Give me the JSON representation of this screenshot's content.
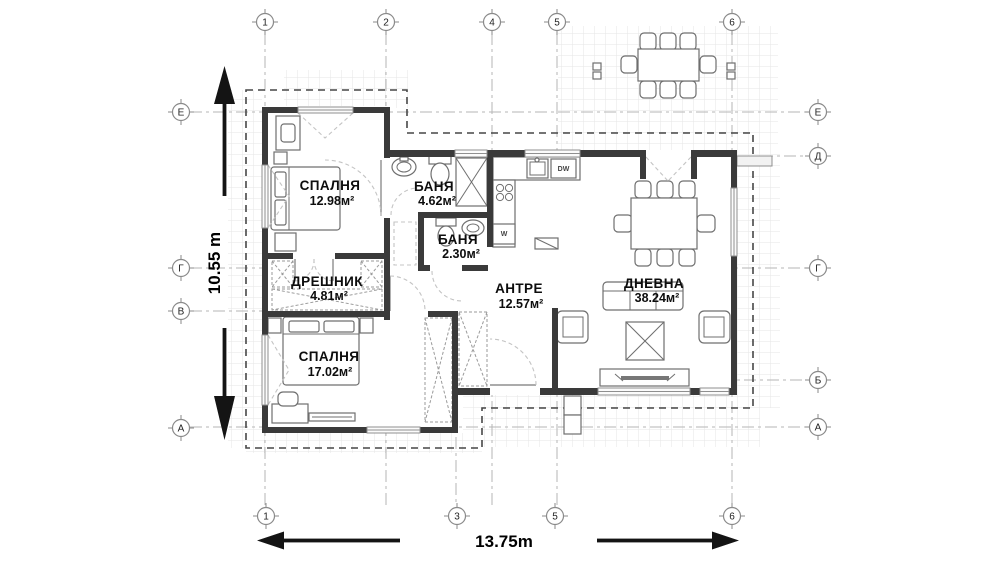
{
  "rooms": [
    {
      "id": "bedroom-1",
      "name": "СПАЛНЯ",
      "area": "12.98м²"
    },
    {
      "id": "bath-1",
      "name": "БАНЯ",
      "area": "4.62м²"
    },
    {
      "id": "bath-2",
      "name": "БАНЯ",
      "area": "2.30м²"
    },
    {
      "id": "closet",
      "name": "ДРЕШНИК",
      "area": "4.81м²"
    },
    {
      "id": "hall",
      "name": "АНТРЕ",
      "area": "12.57м²"
    },
    {
      "id": "living",
      "name": "ДНЕВНА",
      "area": "38.24м²"
    },
    {
      "id": "bedroom-2",
      "name": "СПАЛНЯ",
      "area": "17.02м²"
    }
  ],
  "dimensions": {
    "width": "13.75m",
    "height": "10.55 m"
  },
  "axes": {
    "top": [
      "1",
      "2",
      "4",
      "5",
      "6"
    ],
    "bottom": [
      "1",
      "3",
      "5",
      "6"
    ],
    "left": [
      "Е",
      "Г",
      "В",
      "А"
    ],
    "right": [
      "Е",
      "Д",
      "Г",
      "Б",
      "А"
    ]
  },
  "appliances": {
    "dishwasher": "DW",
    "washer": "W"
  },
  "colors": {
    "wall": "#3a3a3a",
    "axis": "#b5b5b5",
    "ink": "#000000"
  }
}
